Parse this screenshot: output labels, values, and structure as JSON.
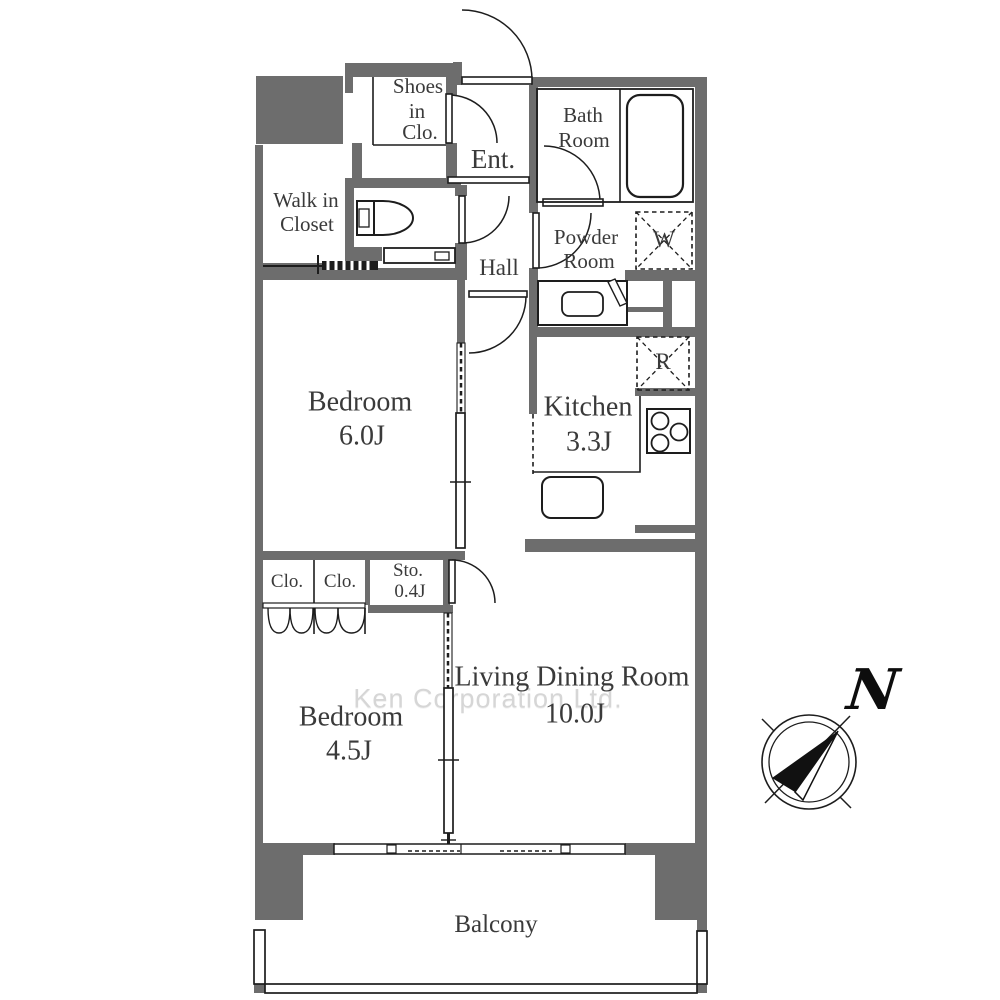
{
  "colors": {
    "wall": "#6d6d6d",
    "line": "#1d1d1d",
    "text": "#3a3a3a",
    "watermark": "#d6d6d6",
    "bg": "#ffffff"
  },
  "watermark": "Ken Corporation Ltd.",
  "compass": {
    "north": "N"
  },
  "rooms": {
    "shoes_closet": {
      "l1": "Shoes",
      "l2": "in",
      "l3": "Clo."
    },
    "entrance": {
      "name": "Ent."
    },
    "bathroom": {
      "l1": "Bath",
      "l2": "Room"
    },
    "walk_in_closet": {
      "l1": "Walk in",
      "l2": "Closet"
    },
    "powder_room": {
      "l1": "Powder",
      "l2": "Room"
    },
    "hall": {
      "name": "Hall"
    },
    "washer": {
      "label": "W"
    },
    "refrigerator": {
      "label": "R"
    },
    "bedroom_main": {
      "name": "Bedroom",
      "size": "6.0J"
    },
    "kitchen": {
      "name": "Kitchen",
      "size": "3.3J"
    },
    "closet_left": {
      "name": "Clo."
    },
    "closet_right": {
      "name": "Clo."
    },
    "storage": {
      "name": "Sto.",
      "size": "0.4J"
    },
    "bedroom_second": {
      "name": "Bedroom",
      "size": "4.5J"
    },
    "living_dining": {
      "name": "Living Dining Room",
      "size": "10.0J"
    },
    "balcony": {
      "name": "Balcony"
    }
  }
}
